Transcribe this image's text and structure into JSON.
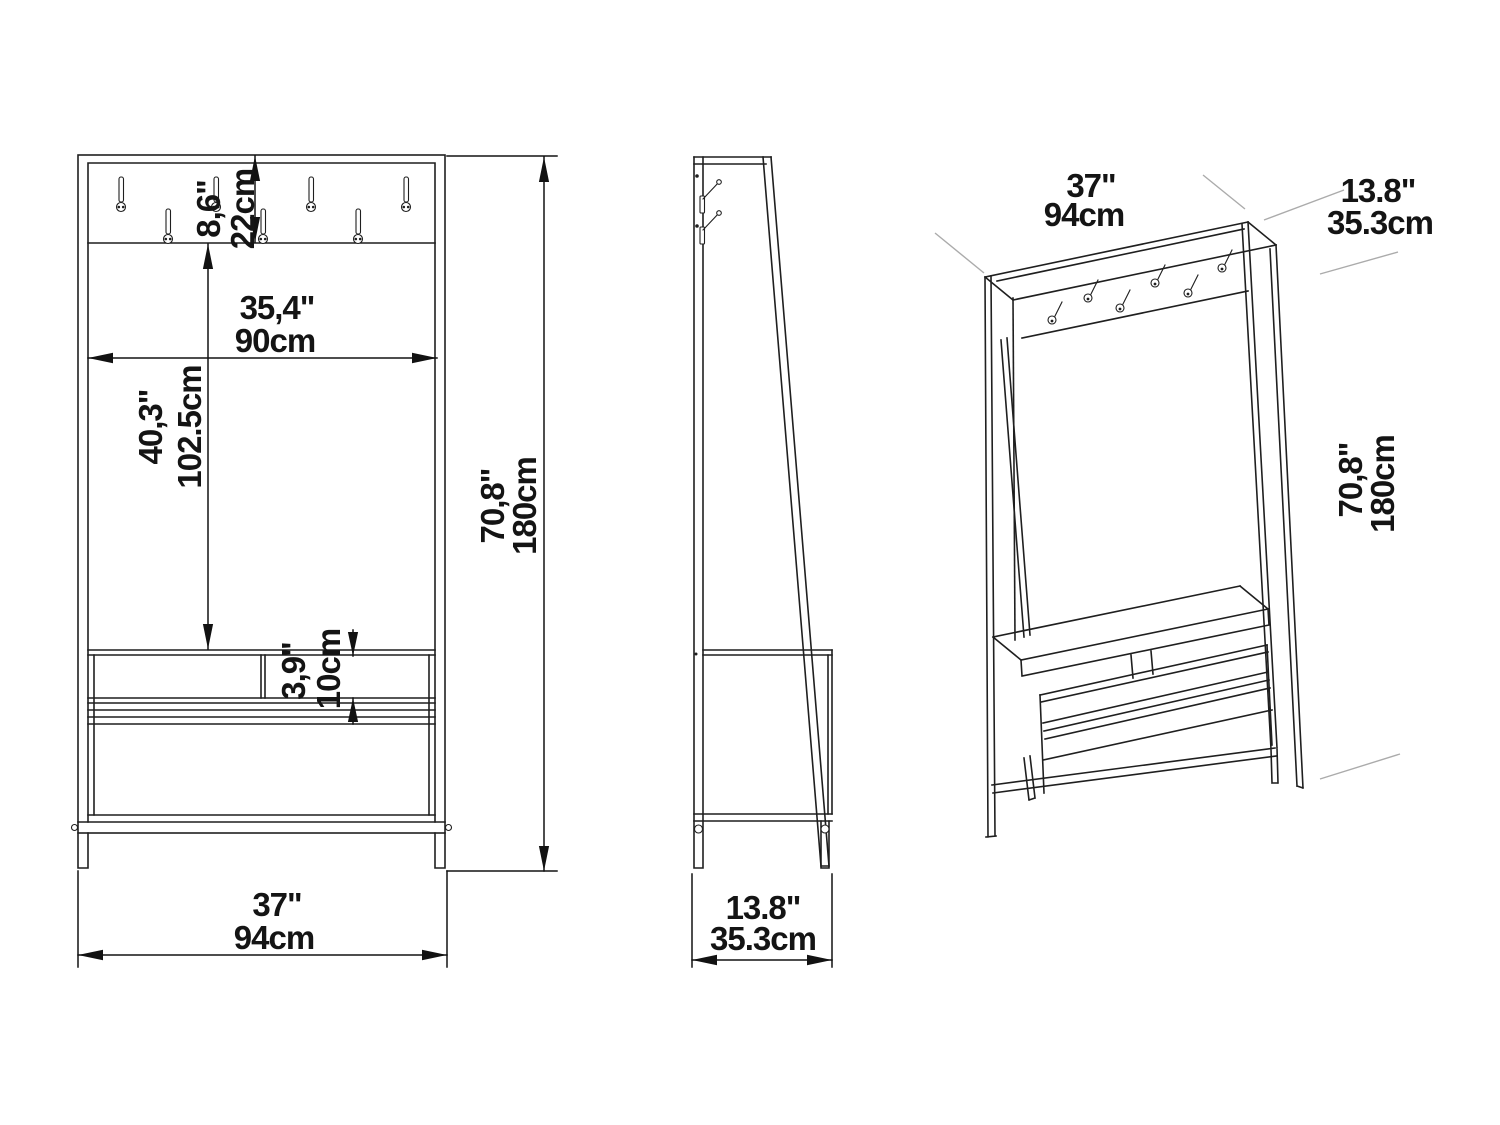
{
  "front_view": {
    "hook_board_height": {
      "in": "8,6\"",
      "cm": "22cm"
    },
    "inner_width": {
      "in": "35,4\"",
      "cm": "90cm"
    },
    "board_to_bench": {
      "in": "40,3\"",
      "cm": "102.5cm"
    },
    "bench_shelf_gap": {
      "in": "3,9\"",
      "cm": "10cm"
    },
    "overall_height": {
      "in": "70,8\"",
      "cm": "180cm"
    },
    "overall_width": {
      "in": "37\"",
      "cm": "94cm"
    }
  },
  "side_view": {
    "overall_depth": {
      "in": "13.8\"",
      "cm": "35.3cm"
    }
  },
  "iso_view": {
    "overall_width": {
      "in": "37\"",
      "cm": "94cm"
    },
    "overall_depth": {
      "in": "13.8\"",
      "cm": "35.3cm"
    },
    "overall_height": {
      "in": "70,8\"",
      "cm": "180cm"
    }
  }
}
